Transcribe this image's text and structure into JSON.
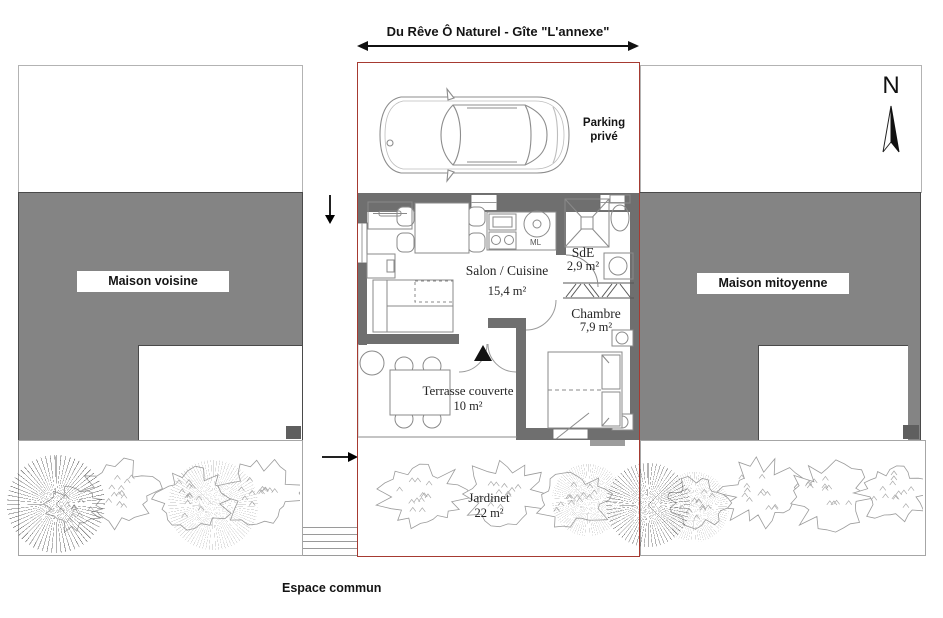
{
  "title": "Du Rêve Ô Naturel - Gîte \"L'annexe\"",
  "compass_label": "N",
  "parking_label": "Parking privé",
  "neighbors": {
    "left_label": "Maison voisine",
    "right_label": "Maison mitoyenne"
  },
  "rooms": {
    "salon": {
      "name": "Salon / Cuisine",
      "area": "15,4 m²"
    },
    "sde": {
      "name": "SdE",
      "area": "2,9 m²"
    },
    "chambre": {
      "name": "Chambre",
      "area": "7,9 m²"
    },
    "terrasse": {
      "name": "Terrasse couverte",
      "area": "10 m²"
    },
    "jardinet": {
      "name": "Jardinet",
      "area": "22 m²"
    }
  },
  "appliances": {
    "washing_machine_label": "ML"
  },
  "common_area_label": "Espace commun",
  "colors": {
    "plot_outline": "#a63a31",
    "building_fill": "#848484",
    "wall_fill": "#6f6f6f"
  }
}
